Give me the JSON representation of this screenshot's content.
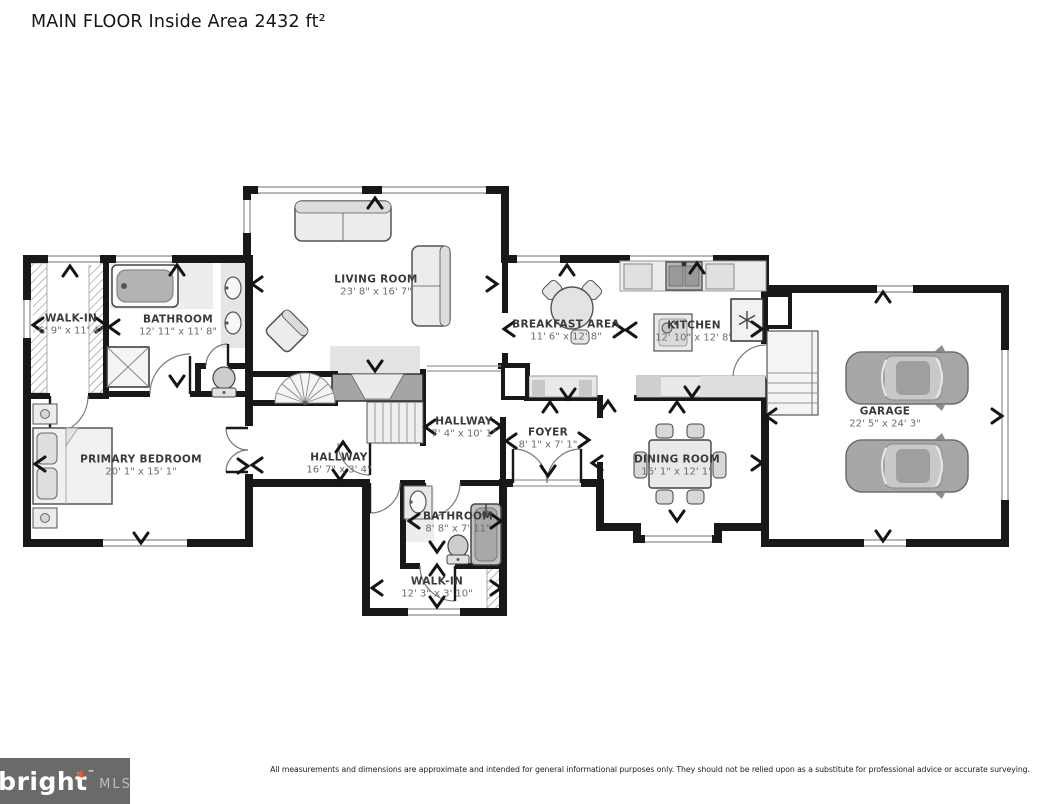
{
  "title": "MAIN FLOOR Inside Area 2432 ft²",
  "rooms": [
    {
      "id": "walk-in-1",
      "name": "WALK-IN",
      "dims": "6' 9\" x 11' 4\""
    },
    {
      "id": "bathroom-1",
      "name": "BATHROOM",
      "dims": "12' 11\" x 11' 8\""
    },
    {
      "id": "living-room",
      "name": "LIVING ROOM",
      "dims": "23' 8\" x 16' 7\""
    },
    {
      "id": "breakfast-area",
      "name": "BREAKFAST AREA",
      "dims": "11' 6\" x 12' 8\""
    },
    {
      "id": "kitchen",
      "name": "KITCHEN",
      "dims": "12' 10\" x 12' 8\""
    },
    {
      "id": "garage",
      "name": "GARAGE",
      "dims": "22' 5\" x 24' 3\""
    },
    {
      "id": "primary-bedroom",
      "name": "PRIMARY BEDROOM",
      "dims": "20' 1\" x 15' 1\""
    },
    {
      "id": "hallway-upper",
      "name": "HALLWAY",
      "dims": "7' 4\" x 10' 1\""
    },
    {
      "id": "hallway-lower",
      "name": "HALLWAY",
      "dims": "16' 7\" x 3' 4\""
    },
    {
      "id": "foyer",
      "name": "FOYER",
      "dims": "8' 1\" x 7' 1\""
    },
    {
      "id": "dining-room",
      "name": "DINING ROOM",
      "dims": "16' 1\" x 12' 1\""
    },
    {
      "id": "bathroom-2",
      "name": "BATHROOM",
      "dims": "8' 8\" x 7' 11\""
    },
    {
      "id": "walk-in-2",
      "name": "WALK-IN",
      "dims": "12' 3\" x 3' 10\""
    }
  ],
  "footer": {
    "brand": "bright",
    "brand_tm": "™",
    "brand_suffix": "MLS",
    "disclaimer": "All measurements and dimensions are approximate and intended for general informational purposes only. They should not be relied upon as a substitute for professional advice or accurate surveying."
  },
  "colors": {
    "wall": "#181818",
    "dim_text": "#6d6d6d",
    "name_text": "#3a3a3a",
    "footer_gray": "#6a6a6a",
    "brand_accent": "#e8542e"
  }
}
